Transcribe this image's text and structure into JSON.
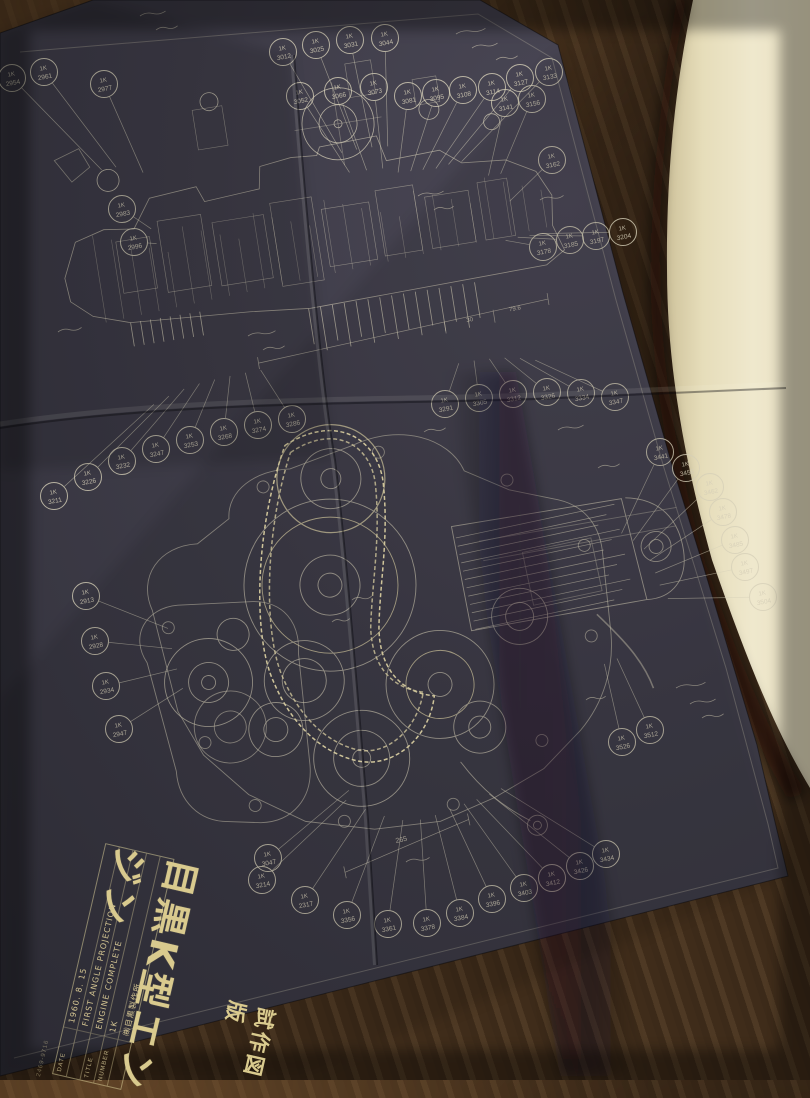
{
  "blueprint": {
    "title_block": {
      "main_title": "目黒K型エンジン",
      "sub_title": "試作図版",
      "rows": [
        {
          "label": "DATE",
          "value": "1960. 8. 15"
        },
        {
          "label": "",
          "value": "FIRST ANGLE PROJECTION"
        },
        {
          "label": "TITLE",
          "value": "ENGINE COMPLETE"
        },
        {
          "label": "NUMBER",
          "value": "1K"
        },
        {
          "label": "",
          "value": "㈱目黒製作所"
        }
      ],
      "edge_code": "2469-9716"
    },
    "balloon_prefix": "1K",
    "dimensions": {
      "main": "265",
      "upper": [
        "30",
        "79.6"
      ]
    },
    "balloon_groups": [
      {
        "name": "top-arc",
        "anchor": [
          390,
          235
        ],
        "items": [
          [
            283,
            52,
            "3012"
          ],
          [
            316,
            45,
            "3025"
          ],
          [
            350,
            40,
            "3031"
          ],
          [
            385,
            38,
            "3044"
          ],
          [
            300,
            96,
            "3052"
          ],
          [
            338,
            91,
            "3066"
          ],
          [
            374,
            87,
            "3073"
          ],
          [
            408,
            96,
            "3081"
          ],
          [
            436,
            93,
            "3095"
          ],
          [
            463,
            90,
            "3108"
          ],
          [
            492,
            87,
            "3114"
          ],
          [
            520,
            78,
            "3127"
          ],
          [
            549,
            72,
            "3133"
          ]
        ]
      },
      {
        "name": "left-cluster",
        "anchor": [
          175,
          245
        ],
        "items": [
          [
            12,
            78,
            "2954"
          ],
          [
            44,
            72,
            "2961"
          ],
          [
            104,
            84,
            "2977"
          ],
          [
            122,
            209,
            "2983"
          ],
          [
            134,
            242,
            "2996"
          ]
        ]
      },
      {
        "name": "right-of-top",
        "anchor": [
          475,
          235
        ],
        "items": [
          [
            505,
            103,
            "3141"
          ],
          [
            532,
            99,
            "3156"
          ],
          [
            552,
            160,
            "3162"
          ],
          [
            543,
            247,
            "3178"
          ],
          [
            570,
            240,
            "3185"
          ],
          [
            596,
            236,
            "3197"
          ],
          [
            623,
            232,
            "3204"
          ]
        ]
      },
      {
        "name": "mid-row-left",
        "anchor": [
          235,
          330
        ],
        "items": [
          [
            54,
            496,
            "3211"
          ],
          [
            88,
            477,
            "3226"
          ],
          [
            122,
            461,
            "3232"
          ],
          [
            156,
            449,
            "3247"
          ],
          [
            190,
            440,
            "3253"
          ],
          [
            224,
            432,
            "3268"
          ],
          [
            258,
            425,
            "3274"
          ],
          [
            292,
            419,
            "3286"
          ]
        ]
      },
      {
        "name": "mid-row-right",
        "anchor": [
          470,
          330
        ],
        "items": [
          [
            445,
            404,
            "3291"
          ],
          [
            479,
            398,
            "3305"
          ],
          [
            513,
            394,
            "3312"
          ],
          [
            547,
            392,
            "3326"
          ],
          [
            581,
            393,
            "3334"
          ],
          [
            615,
            397,
            "3347"
          ]
        ]
      },
      {
        "name": "left-column",
        "anchor": [
          235,
          655
        ],
        "items": [
          [
            86,
            596,
            "2913"
          ],
          [
            95,
            641,
            "2928"
          ],
          [
            106,
            686,
            "2934"
          ],
          [
            119,
            729,
            "2947"
          ]
        ]
      },
      {
        "name": "bottom-arc",
        "anchor": [
          415,
          735
        ],
        "items": [
          [
            268,
            858,
            "3047"
          ],
          [
            262,
            880,
            "3214"
          ],
          [
            305,
            900,
            "2317"
          ],
          [
            347,
            915,
            "3356"
          ],
          [
            388,
            924,
            "3361"
          ],
          [
            427,
            923,
            "3378"
          ],
          [
            460,
            913,
            "3384"
          ],
          [
            492,
            899,
            "3396"
          ],
          [
            524,
            888,
            "3403"
          ],
          [
            552,
            878,
            "3412"
          ],
          [
            580,
            866,
            "3426"
          ],
          [
            606,
            854,
            "3434"
          ]
        ]
      },
      {
        "name": "right-cluster",
        "anchor": [
          590,
          600
        ],
        "items": [
          [
            660,
            452,
            "3441"
          ],
          [
            686,
            468,
            "3456"
          ],
          [
            710,
            487,
            "3462"
          ],
          [
            723,
            512,
            "3478"
          ],
          [
            735,
            540,
            "3485"
          ],
          [
            745,
            567,
            "3497"
          ],
          [
            763,
            597,
            "3504"
          ],
          [
            650,
            730,
            "3512"
          ],
          [
            622,
            742,
            "3526"
          ]
        ]
      }
    ]
  },
  "colors": {
    "paper": "#3e3c48",
    "ink": "#d6cfb8",
    "chain_highlight": "#f0e4b2",
    "gold_title": "#d9ca8e",
    "fabric": "#44301c",
    "page": "#ece4c8"
  }
}
